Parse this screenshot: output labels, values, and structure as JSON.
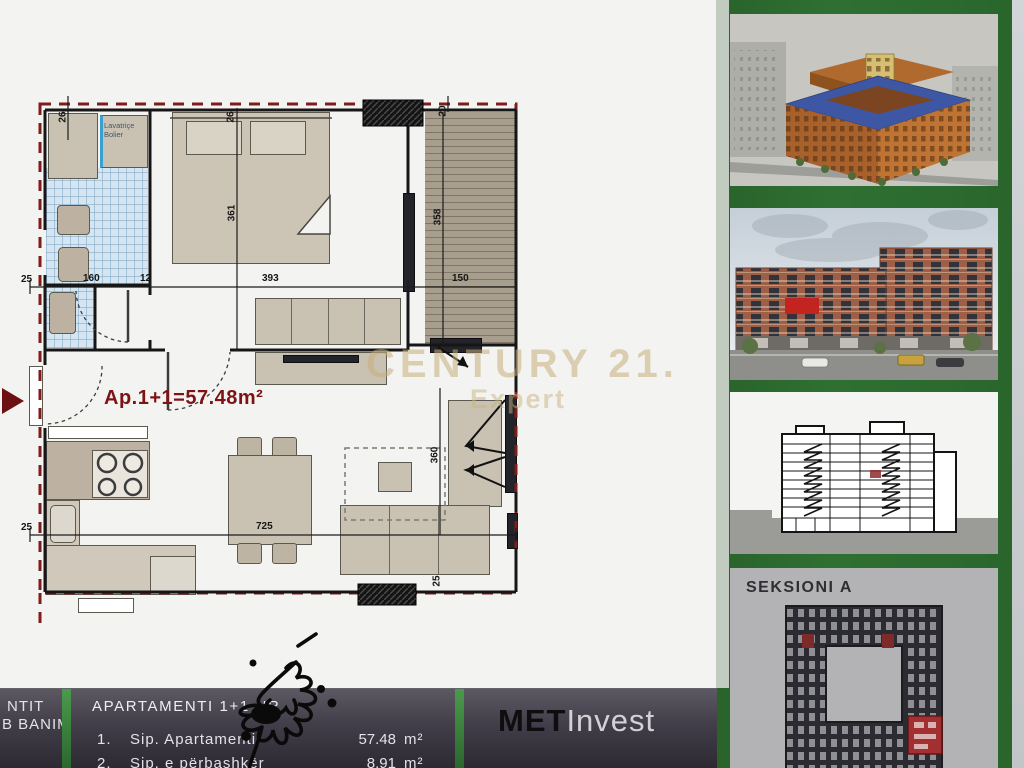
{
  "watermark": {
    "line1": "CENTURY 21.",
    "line2": "Expert"
  },
  "plan": {
    "area_label": "Ap.1+1=57.48m²",
    "laundry_label": "Lavatriçe\nBolier",
    "dims": {
      "top_26a": "26",
      "top_26b": "26",
      "top_20": "20",
      "mid_25": "25",
      "mid_160": "160",
      "mid_12": "12",
      "mid_393": "393",
      "mid_150": "150",
      "bed_361": "361",
      "balc_358": "358",
      "liv_360": "360",
      "bot_25": "25",
      "bot_725": "725",
      "bot_25r": "25"
    }
  },
  "sidebar": {
    "section_label": "SEKSIONI A"
  },
  "bottom_bar": {
    "left_line1": "NTIT",
    "left_line2": "B BANIM",
    "title": "APARTAMENTI 1+1 NR",
    "rows": [
      {
        "no": "1.",
        "label": "Sip. Apartamenti",
        "value": "57.48",
        "unit": "m²"
      },
      {
        "no": "2.",
        "label": "Sip. e përbashkër",
        "value": "8.91",
        "unit": "m²"
      }
    ],
    "logo_part1": "MET",
    "logo_part2": "Invest"
  },
  "colors": {
    "sidebar_green": "#2e6c2e",
    "boundary_red": "#7e1b1b",
    "area_label_red": "#7c1416",
    "unit_highlight_red": "#b03030"
  }
}
